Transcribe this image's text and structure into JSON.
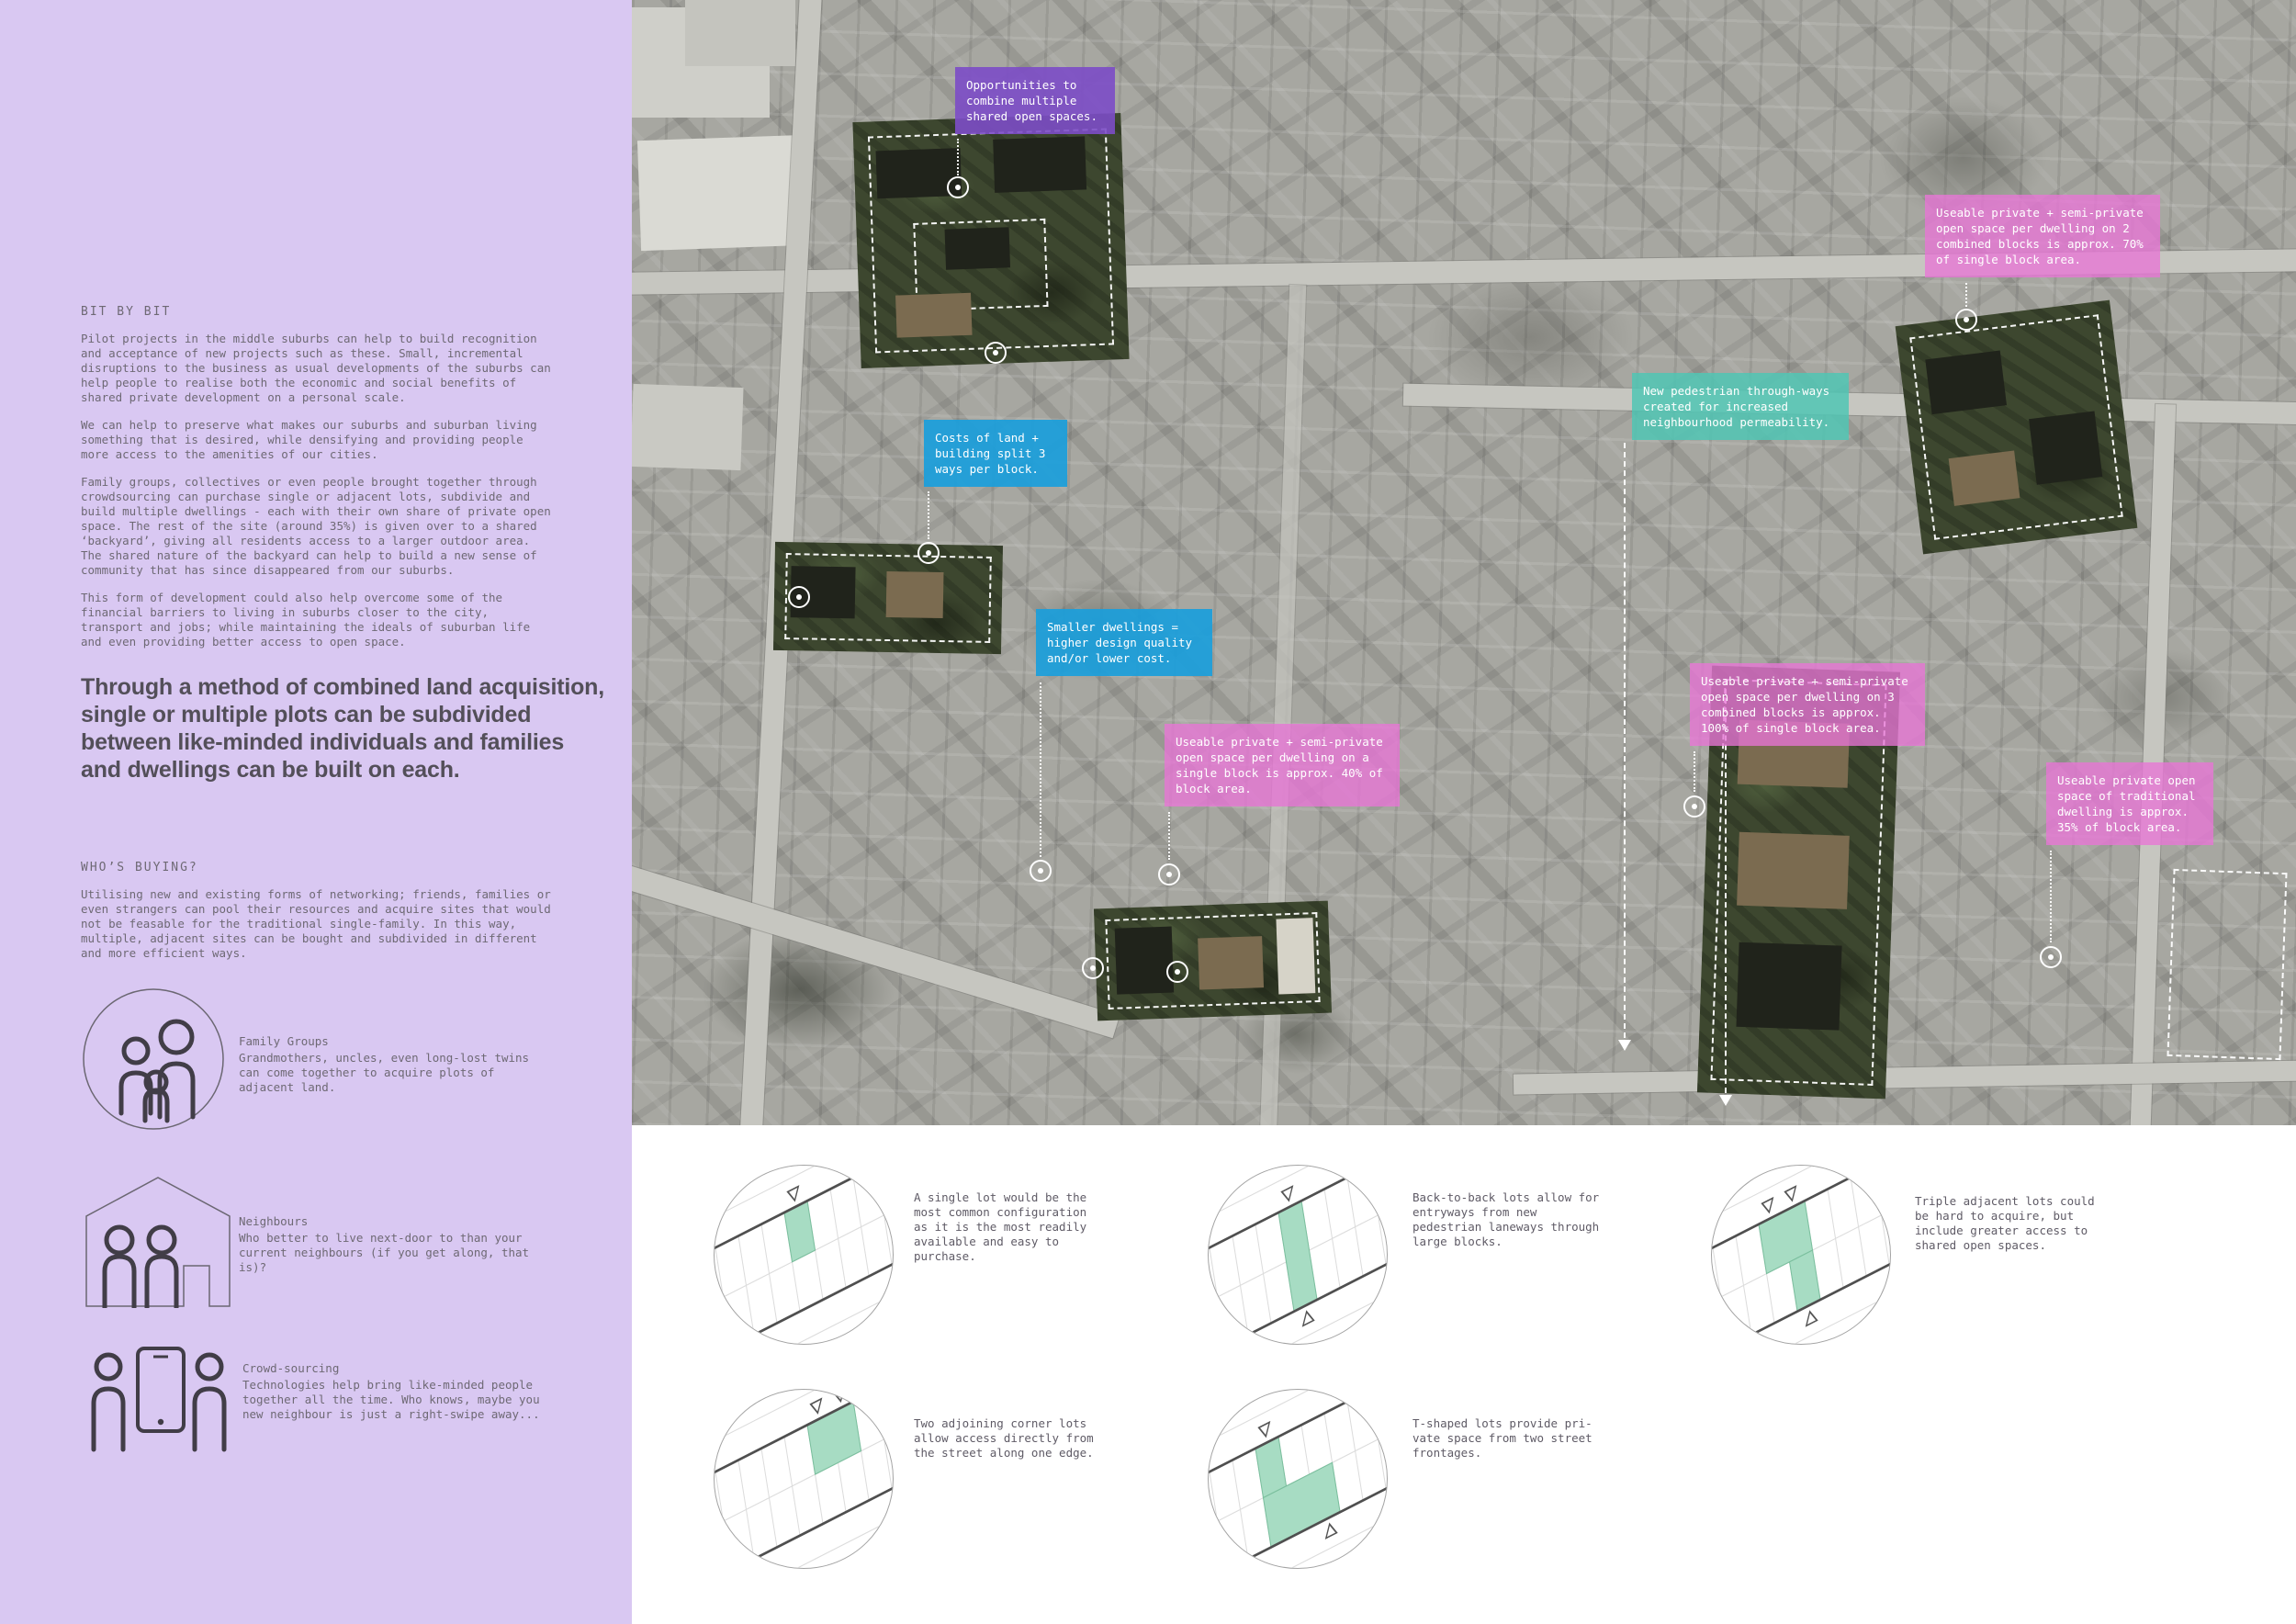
{
  "sidebar": {
    "section1_heading": "BIT BY BIT",
    "paragraphs": [
      "Pilot projects in the middle suburbs can help to build recognition and acceptance of new projects such as these. Small, incremental disruptions to the business as usual developments of the suburbs can help people to realise both the economic and social benefits of shared private development on a personal scale.",
      "We can help to preserve what makes our suburbs and suburban living something that is desired, while densifying and providing people more access to the amenities of our cities.",
      "Family groups, collectives or even people brought together through crowdsourcing can purchase single or adjacent lots, subdivide and build multiple dwellings - each with their own share of private open space. The rest of the site (around 35%) is given over to a shared ‘backyard’, giving all residents access to a larger outdoor area. The shared nature of the backyard can help to build a new sense of community that has since disappeared from our suburbs.",
      "This form of development could also help overcome some of the financial barriers to living in suburbs closer to the city, transport and jobs; while maintaining the ideals of suburban life and even providing better access to open space."
    ],
    "headline": "Through a method of combined land acquisition, single or multiple plots can be subdivided between like-minded individuals and families and dwellings can be built on each.",
    "section2_heading": "WHO’S BUYING?",
    "section2_paragraph": "Utilising new and existing forms of networking; friends, families or even strangers can pool their resources and acquire sites that would not be feasable for the traditional single-family. In this way, multiple, adjacent sites can be bought and subdivided in different and more efficient ways.",
    "groups": [
      {
        "icon": "family-group-icon",
        "title": "Family Groups",
        "description": "Grandmothers, uncles, even long-lost twins can come together to acquire plots of adjacent land."
      },
      {
        "icon": "neighbours-house-icon",
        "title": "Neighbours",
        "description": "Who better to live next-door to than your current neighbours (if you get along, that is)?"
      },
      {
        "icon": "crowdsourcing-phone-icon",
        "title": "Crowd-sourcing",
        "description": "Technologies help bring like-minded people together all the time. Who knows, maybe you new neighbour is just a right-swipe away..."
      }
    ],
    "background_color": "#d9c8f2"
  },
  "map": {
    "labels": [
      {
        "text": "Opportunities to combine multiple shared open spaces.",
        "color": "#7c4dc6"
      },
      {
        "text": "Useable private + semi-private open space per dwelling on 2 combined blocks is approx. 70% of single block area.",
        "color": "#e874d6"
      },
      {
        "text": "New pedestrian through-ways created for increased neighbourhood permeability.",
        "color": "#50c6b4"
      },
      {
        "text": "Costs of land + building split 3 ways per block.",
        "color": "#1a9edb"
      },
      {
        "text": "Smaller dwellings = higher design quality and/or lower cost.",
        "color": "#1a9edb"
      },
      {
        "text": "Useable private + semi-private open space per dwelling on a single block is approx. 40% of block area.",
        "color": "#e874d6"
      },
      {
        "text": "Useable private + semi-private open space per dwelling on 3 combined blocks is approx. 100% of single block area.",
        "color": "#e874d6"
      },
      {
        "text": "Useable private open space of traditional dwelling is approx. 35% of block area.",
        "color": "#e874d6"
      }
    ],
    "site_green_color": "#3d472f"
  },
  "diagrams": {
    "accent_color": "#a7dcc3",
    "items": [
      {
        "text": "A single lot would be the most common configuration as it is the most readily available and easy to purchase."
      },
      {
        "text": "Back-to-back lots allow for entryways from new pedestrian laneways through large blocks."
      },
      {
        "text": "Triple adjacent lots could be hard to acquire, but include greater access to shared open spaces."
      },
      {
        "text": "Two adjoining corner lots allow access directly from the street along one edge."
      },
      {
        "text": "T-shaped lots provide pri-vate space from two street frontages."
      }
    ]
  }
}
